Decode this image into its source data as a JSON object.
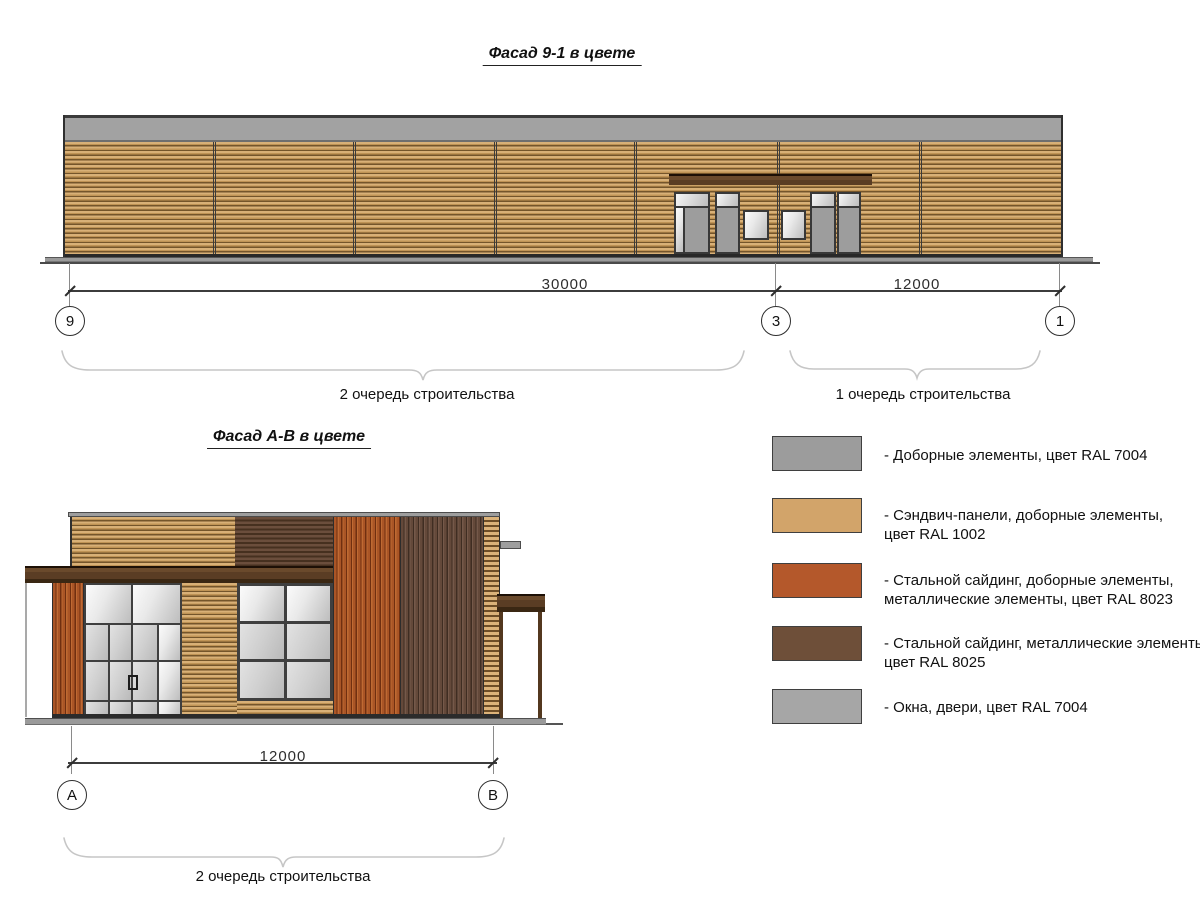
{
  "drawing": {
    "facade_91": {
      "title": "Фасад 9-1 в цвете",
      "dim_30000": "30000",
      "dim_12000": "12000",
      "axis_9": "9",
      "axis_3": "3",
      "axis_1": "1",
      "phase_2_label": "2 очередь строительства",
      "phase_1_label": "1 очередь строительства"
    },
    "facade_ab": {
      "title": "Фасад А-В в цвете",
      "dim_12000": "12000",
      "axis_a": "А",
      "axis_b": "В",
      "phase_2_label": "2 очередь строительства"
    },
    "legend": {
      "items": [
        {
          "color": "#9c9c9c",
          "label": "- Доборные элементы, цвет RAL 7004"
        },
        {
          "color": "#d2a46a",
          "label": "- Сэндвич-панели, доборные элементы,\nцвет RAL 1002"
        },
        {
          "color": "#b4582b",
          "label": "- Стальной сайдинг, доборные элементы,\nметаллические элементы, цвет RAL 8023"
        },
        {
          "color": "#6e4f39",
          "label": "- Стальной сайдинг, металлические элементы,\nцвет RAL 8025"
        },
        {
          "color": "#a6a6a6",
          "label": "- Окна, двери, цвет RAL 7004"
        }
      ]
    },
    "colors": {
      "ral_7004": "#9c9c9c",
      "ral_1002": "#d2a46a",
      "ral_8023": "#b4582b",
      "ral_8025": "#6e4f39"
    }
  }
}
